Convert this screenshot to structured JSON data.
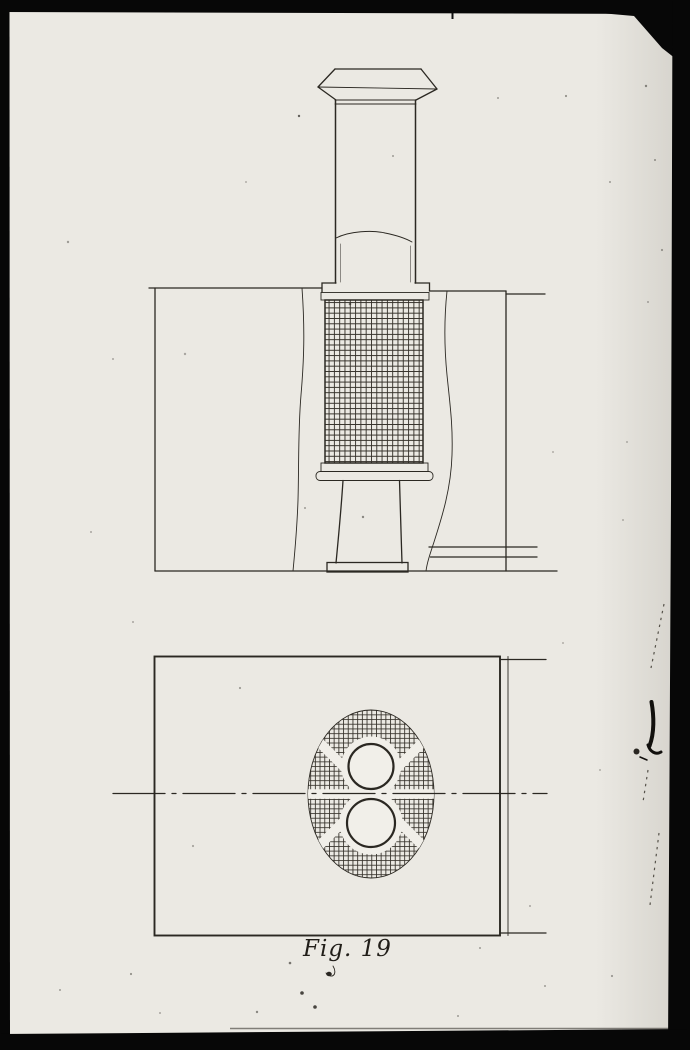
{
  "figure": {
    "caption": "Fig. 19"
  },
  "colors": {
    "paper": "#ebe9e3",
    "blank": "#f1efe9",
    "ink": "#2b2822",
    "hatch": "#35312a",
    "frame": "#070707"
  }
}
